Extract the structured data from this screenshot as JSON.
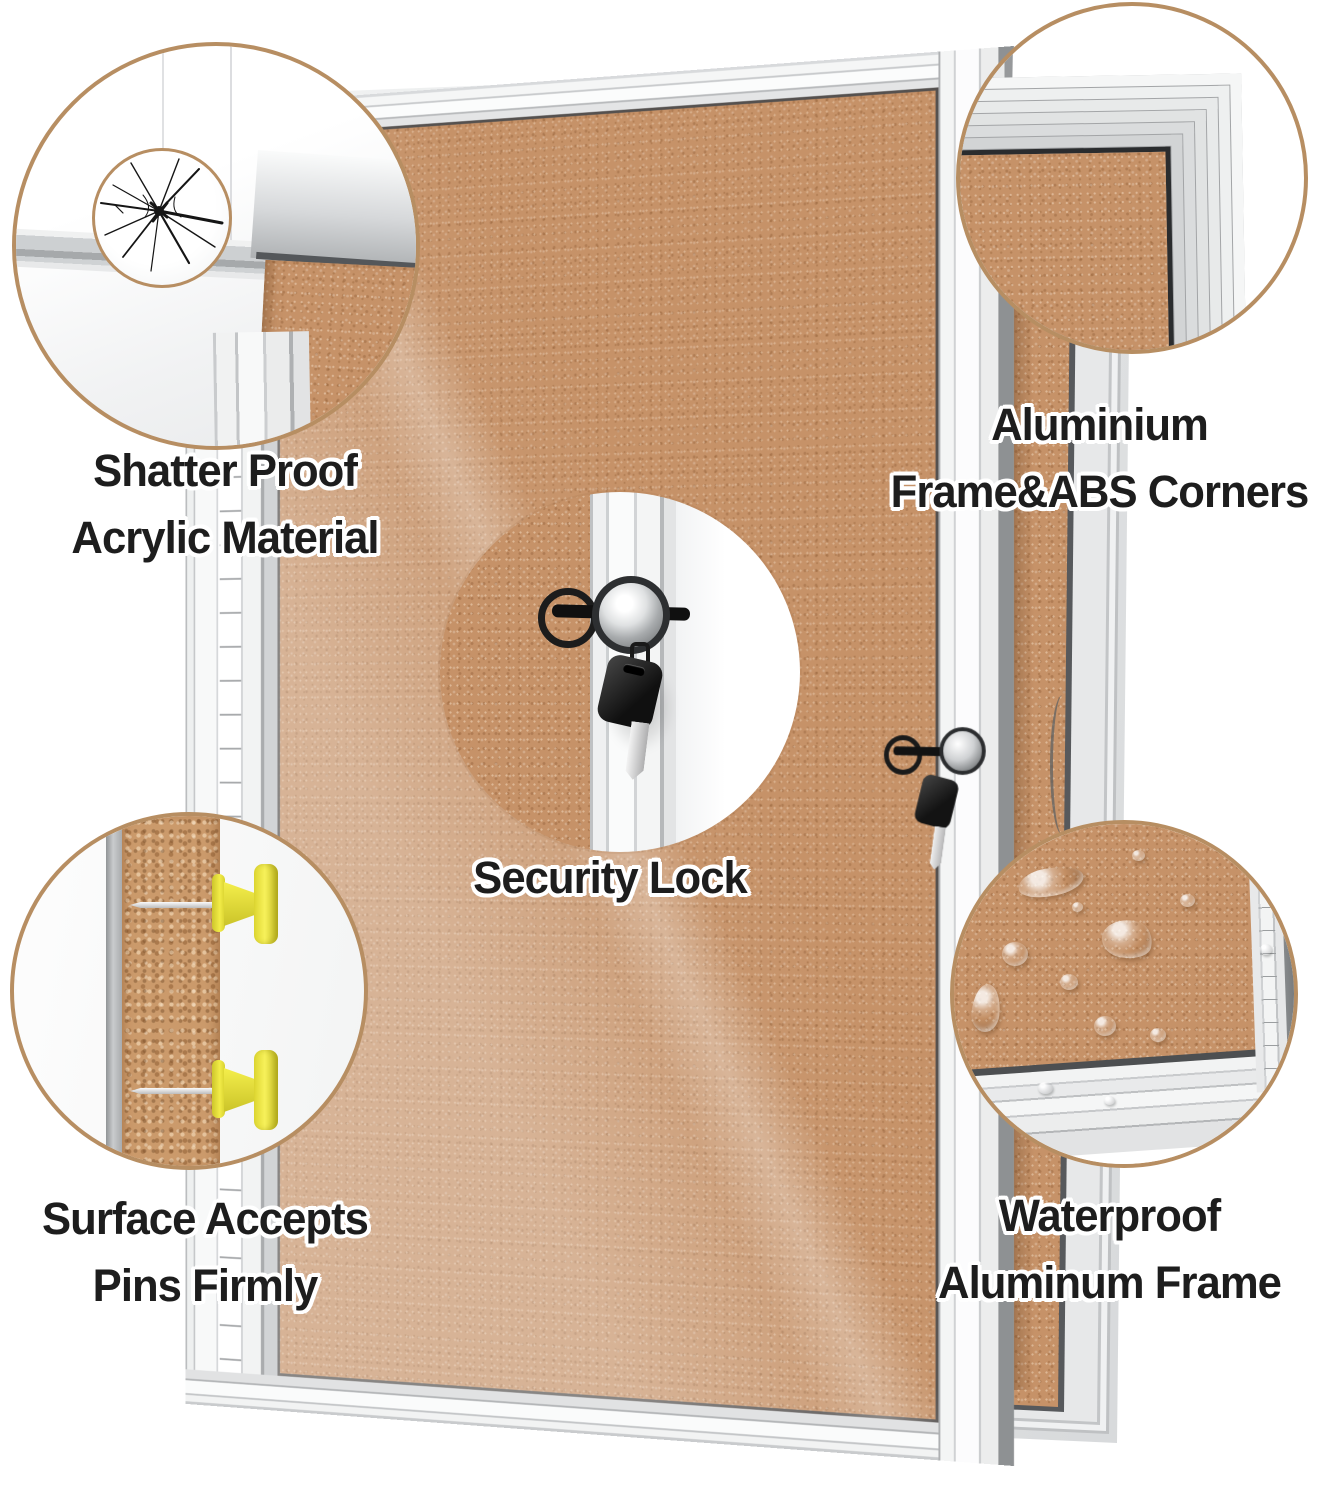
{
  "labels": {
    "shatter": [
      "Shatter Proof",
      "Acrylic Material"
    ],
    "frame": [
      "Aluminium",
      "Frame&ABS Corners"
    ],
    "lock": [
      "Security Lock"
    ],
    "pins": [
      "Surface Accepts",
      "Pins Firmly"
    ],
    "waterproof": [
      "Waterproof",
      "Aluminum Frame"
    ]
  },
  "colors": {
    "background": "#ffffff",
    "cork": "#c69268",
    "aluminum_light": "#f4f5f5",
    "aluminum_mid": "#cfd1d3",
    "aluminum_dark": "#8e9193",
    "callout_ring": "#b78e62",
    "label_text": "#1d1d1d",
    "label_outline": "#ffffff",
    "pin_yellow": "#f1ea43",
    "key_fob_black": "#1c1c1c"
  }
}
